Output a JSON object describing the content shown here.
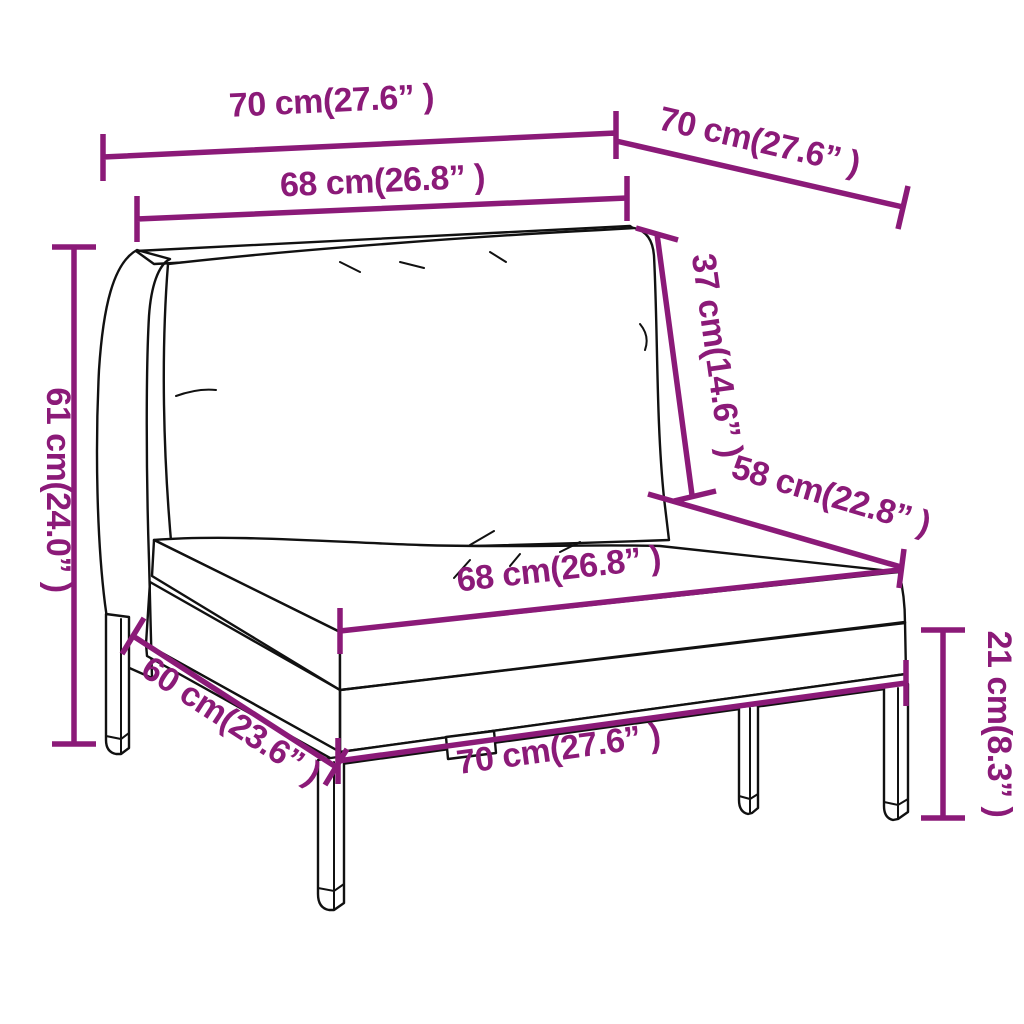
{
  "figure": {
    "background_color": "#ffffff",
    "outline_color": "#111111",
    "dimension_color": "#8B1A78",
    "dimensions": {
      "top_width": "70 cm(27.6” )",
      "top_depth": "70 cm(27.6” )",
      "back_width": "68 cm(26.8” )",
      "back_cushion_height": "37 cm(14.6” )",
      "overall_height": "61 cm(24.0” )",
      "seat_diagonal_depth": "58 cm(22.8” )",
      "seat_width": "68 cm(26.8” )",
      "base_depth": "60 cm(23.6” )",
      "base_width": "70 cm(27.6” )",
      "leg_height": "21 cm(8.3” )"
    }
  }
}
